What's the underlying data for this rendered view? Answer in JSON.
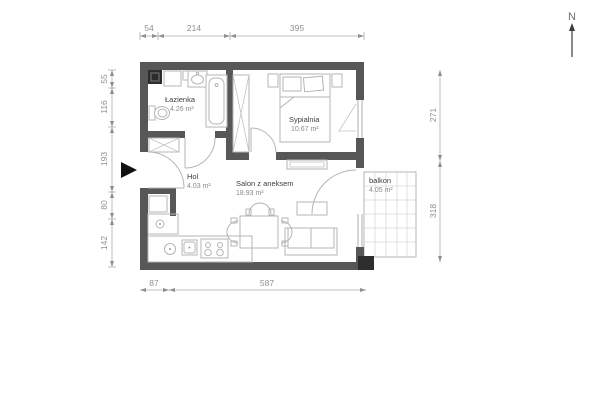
{
  "north": {
    "label": "N"
  },
  "rooms": {
    "bathroom": {
      "name": "Łazienka",
      "area": "4.26 m²"
    },
    "bedroom": {
      "name": "Sypialnia",
      "area": "10.67 m²"
    },
    "hall": {
      "name": "Hol",
      "area": "4.03 m²"
    },
    "living": {
      "name": "Salon z aneksem",
      "area": "18.93 m²"
    },
    "balcony": {
      "name": "balkon",
      "area": "4.05 m²"
    }
  },
  "dimensions": {
    "top": [
      "54",
      "214",
      "395"
    ],
    "left": [
      "55",
      "116",
      "193",
      "80",
      "142"
    ],
    "right": [
      "271",
      "318"
    ],
    "bottom": [
      "87",
      "587"
    ]
  },
  "colors": {
    "wall": "#575757",
    "wall_dark": "#2d2d2d",
    "furniture_line": "#b5b5b5",
    "dimension_line": "#8f8f8f",
    "label_text": "#3d3d3d"
  }
}
